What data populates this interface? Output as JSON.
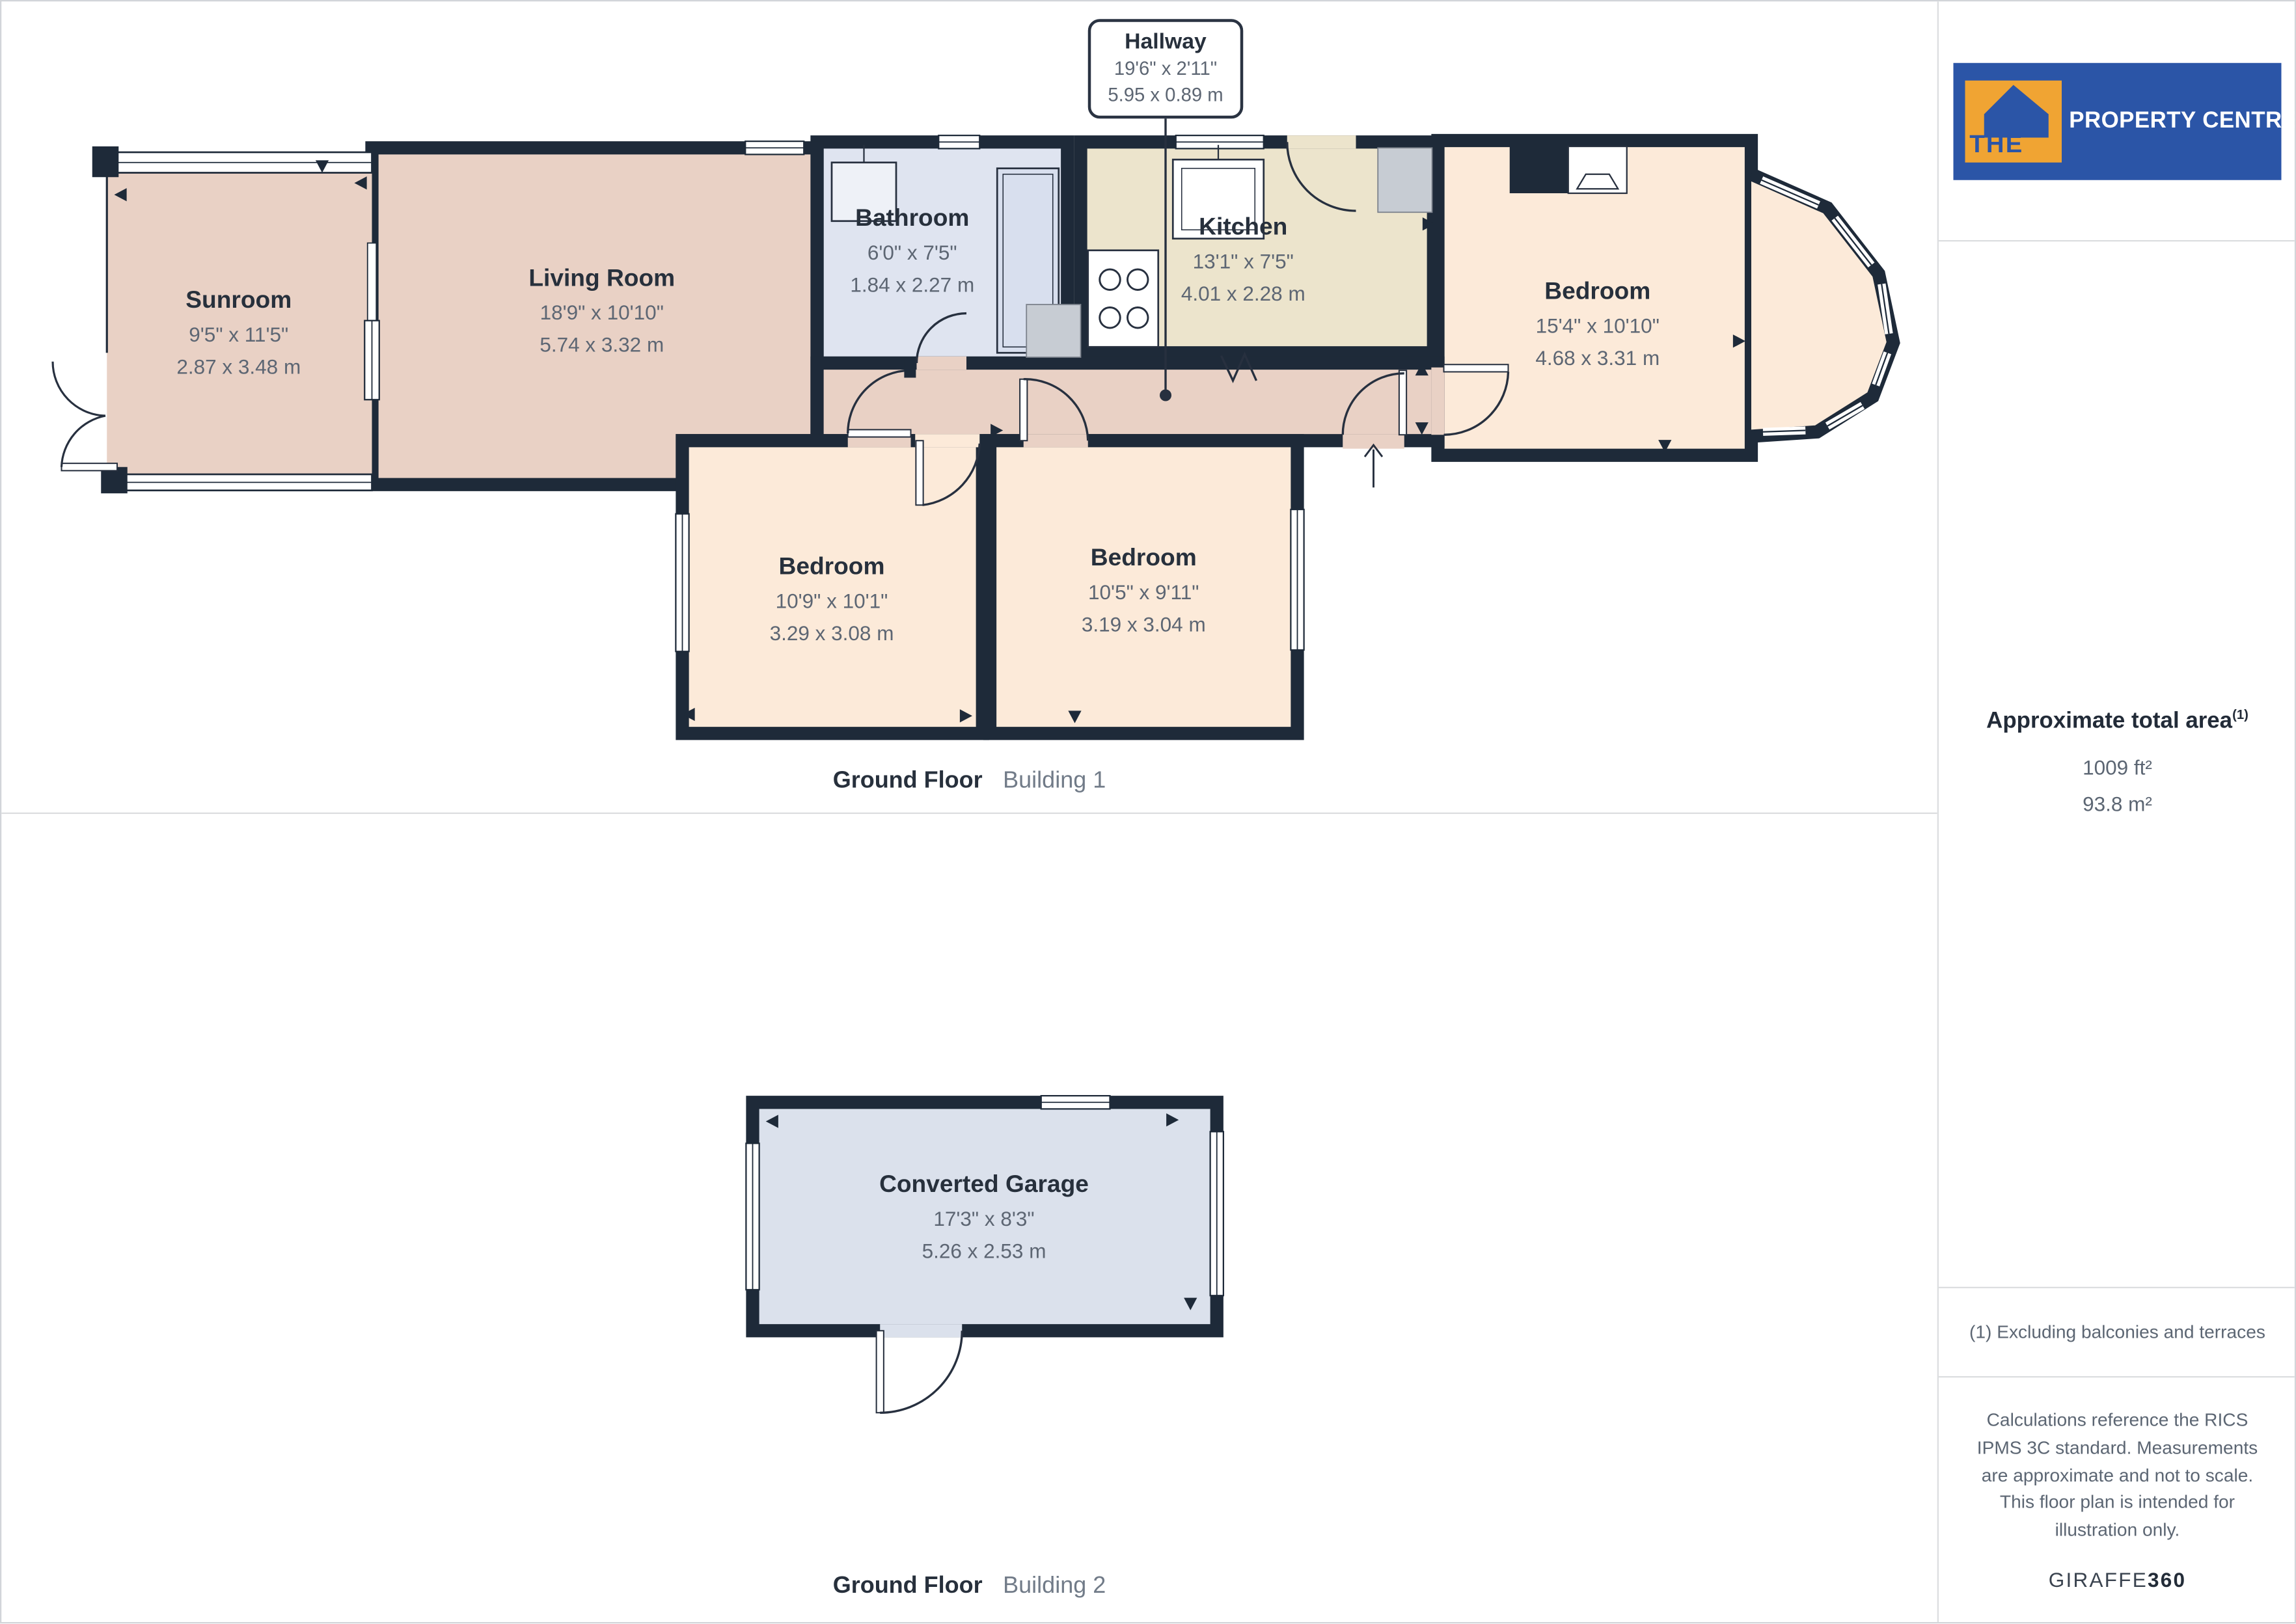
{
  "colors": {
    "wall": "#1e2a39",
    "room_pink": "#e9d1c5",
    "room_peach": "#fcead9",
    "room_cream": "#ece4cc",
    "room_bath": "#dfe4f0",
    "room_garage": "#dbe1ec",
    "logo_blue": "#2b55a7",
    "logo_orange": "#f0a433"
  },
  "callout": {
    "title": "Hallway",
    "imperial": "19'6\" x 2'11\"",
    "metric": "5.95 x 0.89 m"
  },
  "rooms": [
    {
      "id": "sunroom",
      "name": "Sunroom",
      "imperial": "9'5\" x 11'5\"",
      "metric": "2.87 x 3.48 m"
    },
    {
      "id": "living-room",
      "name": "Living Room",
      "imperial": "18'9\" x 10'10\"",
      "metric": "5.74 x 3.32 m"
    },
    {
      "id": "bathroom",
      "name": "Bathroom",
      "imperial": "6'0\" x 7'5\"",
      "metric": "1.84 x 2.27 m"
    },
    {
      "id": "kitchen",
      "name": "Kitchen",
      "imperial": "13'1\" x 7'5\"",
      "metric": "4.01 x 2.28 m"
    },
    {
      "id": "bedroom-main",
      "name": "Bedroom",
      "imperial": "15'4\" x 10'10\"",
      "metric": "4.68 x 3.31 m"
    },
    {
      "id": "bedroom-left",
      "name": "Bedroom",
      "imperial": "10'9\" x 10'1\"",
      "metric": "3.29 x 3.08 m"
    },
    {
      "id": "bedroom-mid",
      "name": "Bedroom",
      "imperial": "10'5\" x 9'11\"",
      "metric": "3.19 x 3.04 m"
    },
    {
      "id": "converted-garage",
      "name": "Converted Garage",
      "imperial": "17'3\" x 8'3\"",
      "metric": "5.26 x 2.53 m"
    }
  ],
  "captions": {
    "building1": {
      "floor": "Ground Floor",
      "building": "Building 1"
    },
    "building2": {
      "floor": "Ground Floor",
      "building": "Building 2"
    }
  },
  "sidebar": {
    "logo": {
      "the": "THE",
      "name": "PROPERTY CENTRE"
    },
    "area_title": "Approximate total area",
    "area_sup": "(1)",
    "area_ft": "1009 ft²",
    "area_m": "93.8 m²",
    "footnote": "(1) Excluding balconies and terraces",
    "disclaimer": "Calculations reference the RICS IPMS 3C standard. Measurements are approximate and not to scale. This floor plan is intended for illustration only.",
    "brand": "GIRAFFE",
    "brand_suffix": "360"
  }
}
